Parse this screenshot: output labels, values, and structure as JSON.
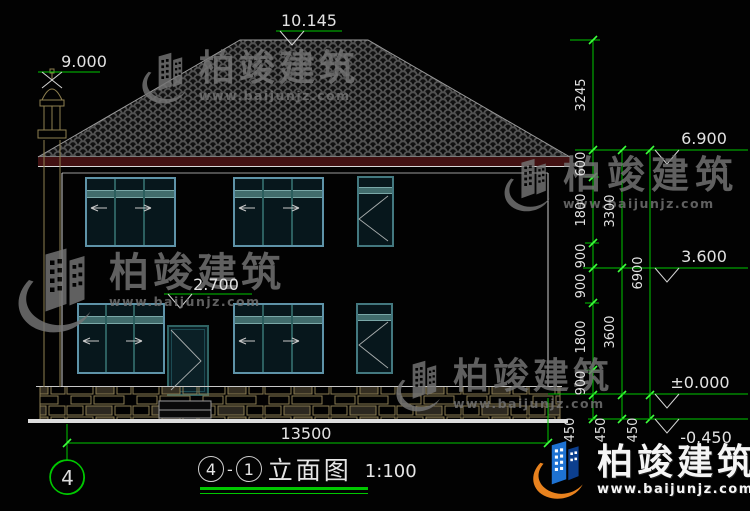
{
  "watermark": {
    "name": "柏竣建筑",
    "url": "www.baijunjz.com"
  },
  "title": {
    "grid_start": "4",
    "grid_end": "1",
    "name": "立面图",
    "scale": "1:100"
  },
  "grid_bubble": "4",
  "levels": {
    "ridge": "10.145",
    "chimney": "9.000",
    "eave": "6.900",
    "floor2": "3.600",
    "door_head": "2.700",
    "ground": "±0.000",
    "grade": "-0.450"
  },
  "dimensions": {
    "total_width": "13500",
    "chain_inner": [
      "3245",
      "600",
      "1800",
      "900",
      "900",
      "1800",
      "900",
      "450"
    ],
    "chain_middle": [
      "3300",
      "3600",
      "450"
    ],
    "chain_outer": [
      "6900",
      "450"
    ]
  },
  "colors": {
    "dimension_green": "#00c800",
    "text_white": "#e2e2e2",
    "fascia_maroon": "#421112",
    "stone_olive": "#8a7c52",
    "window_frame_blue": "#5e93a8",
    "window_teal": "#2f6363",
    "logo_blue": "#1e72d2",
    "logo_orange": "#e8821e"
  }
}
